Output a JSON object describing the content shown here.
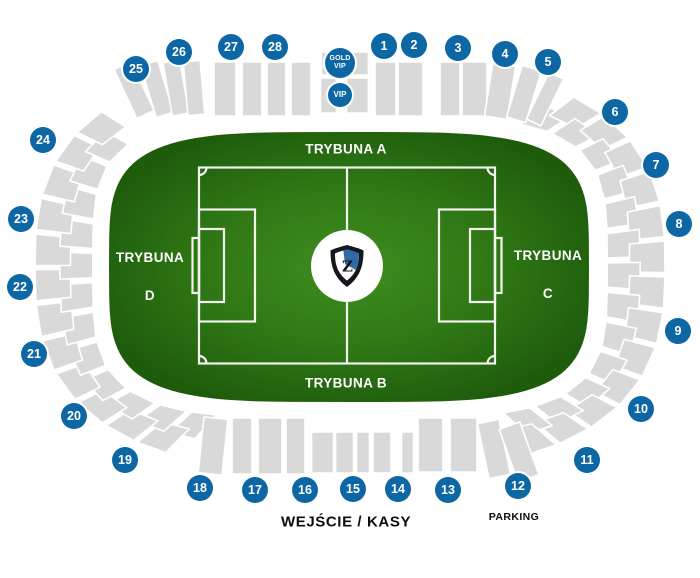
{
  "map": {
    "stand_labels": {
      "north": "TRYBUNA A",
      "south": "TRYBUNA B",
      "east_line1": "TRYBUNA",
      "east_line2": "C",
      "west_line1": "TRYBUNA",
      "west_line2": "D"
    },
    "vip": {
      "gold_line1": "GOLD",
      "gold_line2": "VIP",
      "vip_label": "VIP"
    },
    "pitch": {
      "center_logo_letter": "Z"
    },
    "footer": {
      "entrance": "WEJŚCIE / KASY",
      "parking": "PARKING"
    },
    "sections": [
      {
        "label": "1",
        "x": 384,
        "y": 46
      },
      {
        "label": "2",
        "x": 414,
        "y": 45
      },
      {
        "label": "3",
        "x": 458,
        "y": 48
      },
      {
        "label": "4",
        "x": 505,
        "y": 54
      },
      {
        "label": "5",
        "x": 548,
        "y": 62
      },
      {
        "label": "6",
        "x": 615,
        "y": 112
      },
      {
        "label": "7",
        "x": 656,
        "y": 165
      },
      {
        "label": "8",
        "x": 679,
        "y": 224
      },
      {
        "label": "9",
        "x": 678,
        "y": 331
      },
      {
        "label": "10",
        "x": 641,
        "y": 409
      },
      {
        "label": "11",
        "x": 587,
        "y": 460
      },
      {
        "label": "12",
        "x": 518,
        "y": 486
      },
      {
        "label": "13",
        "x": 448,
        "y": 490
      },
      {
        "label": "14",
        "x": 398,
        "y": 489
      },
      {
        "label": "15",
        "x": 353,
        "y": 489
      },
      {
        "label": "16",
        "x": 305,
        "y": 490
      },
      {
        "label": "17",
        "x": 255,
        "y": 490
      },
      {
        "label": "18",
        "x": 200,
        "y": 488
      },
      {
        "label": "19",
        "x": 125,
        "y": 460
      },
      {
        "label": "20",
        "x": 74,
        "y": 416
      },
      {
        "label": "21",
        "x": 34,
        "y": 354
      },
      {
        "label": "22",
        "x": 20,
        "y": 287
      },
      {
        "label": "23",
        "x": 21,
        "y": 219
      },
      {
        "label": "24",
        "x": 43,
        "y": 140
      },
      {
        "label": "25",
        "x": 136,
        "y": 69
      },
      {
        "label": "26",
        "x": 179,
        "y": 52
      },
      {
        "label": "27",
        "x": 231,
        "y": 47
      },
      {
        "label": "28",
        "x": 275,
        "y": 47
      }
    ],
    "colors": {
      "badge_blue": "#0e67a5",
      "stand_gray": "#d9d9d9",
      "pitch_green_center": "#3f8e20",
      "pitch_green_mid": "#2f7715",
      "pitch_green_edge": "#1e5c0c",
      "line_white": "#f1f5ee",
      "crest_blue": "#2d6ba9",
      "crest_dark": "#14181d"
    }
  }
}
